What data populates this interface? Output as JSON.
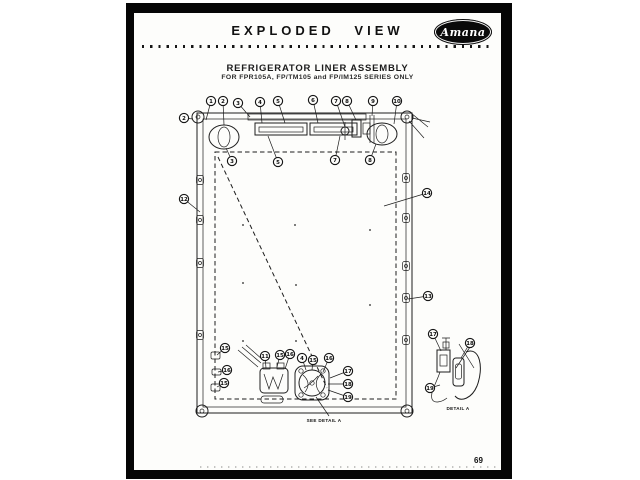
{
  "page": {
    "header": {
      "title": "EXPLODED VIEW",
      "brand": "Amana"
    },
    "subject": {
      "line1": "REFRIGERATOR LINER ASSEMBLY",
      "line2": "FOR FPR105A, FP/TM105 and FP/IM125 SERIES ONLY"
    },
    "captions": {
      "see_detail": "SEE DETAIL A",
      "detail": "DETAIL A"
    },
    "page_number": "69"
  },
  "colors": {
    "ink": "#1d1d1d",
    "paper": "#fdfdfb",
    "border": "#050505"
  },
  "icons": {
    "brand_logo": "amana-oval-logo"
  },
  "callouts": [
    {
      "n": "1",
      "x": 211,
      "y": 101,
      "lx": 206,
      "ly": 120
    },
    {
      "n": "2",
      "x": 223,
      "y": 101,
      "lx": 224,
      "ly": 125
    },
    {
      "n": "3",
      "x": 238,
      "y": 103,
      "lx": 250,
      "ly": 117
    },
    {
      "n": "4",
      "x": 260,
      "y": 102,
      "lx": 262,
      "ly": 123
    },
    {
      "n": "5",
      "x": 278,
      "y": 101,
      "lx": 285,
      "ly": 123
    },
    {
      "n": "6",
      "x": 313,
      "y": 100,
      "lx": 318,
      "ly": 123
    },
    {
      "n": "7",
      "x": 336,
      "y": 101,
      "lx": 345,
      "ly": 127
    },
    {
      "n": "8",
      "x": 347,
      "y": 101,
      "lx": 356,
      "ly": 120
    },
    {
      "n": "9",
      "x": 373,
      "y": 101,
      "lx": 372,
      "ly": 116
    },
    {
      "n": "10",
      "x": 397,
      "y": 101,
      "lx": 394,
      "ly": 124
    },
    {
      "n": "2",
      "x": 184,
      "y": 118,
      "lx": 193,
      "ly": 119
    },
    {
      "n": "3",
      "x": 232,
      "y": 161,
      "lx": 226,
      "ly": 148
    },
    {
      "n": "5",
      "x": 278,
      "y": 162,
      "lx": 268,
      "ly": 136
    },
    {
      "n": "7",
      "x": 335,
      "y": 160,
      "lx": 340,
      "ly": 136
    },
    {
      "n": "8",
      "x": 370,
      "y": 160,
      "lx": 376,
      "ly": 144
    },
    {
      "n": "12",
      "x": 184,
      "y": 199,
      "lx": 200,
      "ly": 212
    },
    {
      "n": "14",
      "x": 427,
      "y": 193,
      "lx": 384,
      "ly": 206
    },
    {
      "n": "13",
      "x": 428,
      "y": 296,
      "lx": 408,
      "ly": 299
    },
    {
      "n": "15",
      "x": 225,
      "y": 348,
      "lx": 217,
      "ly": 355
    },
    {
      "n": "16",
      "x": 227,
      "y": 370,
      "lx": 218,
      "ly": 372
    },
    {
      "n": "15",
      "x": 224,
      "y": 383,
      "lx": 217,
      "ly": 387
    },
    {
      "n": "11",
      "x": 265,
      "y": 356,
      "lx": 266,
      "ly": 368
    },
    {
      "n": "15",
      "x": 280,
      "y": 355,
      "lx": 277,
      "ly": 367
    },
    {
      "n": "16",
      "x": 290,
      "y": 354,
      "lx": 285,
      "ly": 369
    },
    {
      "n": "4",
      "x": 302,
      "y": 358,
      "lx": 306,
      "ly": 370
    },
    {
      "n": "15",
      "x": 313,
      "y": 360,
      "lx": 312,
      "ly": 370
    },
    {
      "n": "16",
      "x": 329,
      "y": 358,
      "lx": 323,
      "ly": 372
    },
    {
      "n": "17",
      "x": 348,
      "y": 371,
      "lx": 330,
      "ly": 378
    },
    {
      "n": "18",
      "x": 348,
      "y": 384,
      "lx": 328,
      "ly": 384
    },
    {
      "n": "19",
      "x": 348,
      "y": 397,
      "lx": 328,
      "ly": 390
    },
    {
      "n": "17",
      "x": 433,
      "y": 334,
      "lx": 441,
      "ly": 351
    },
    {
      "n": "18",
      "x": 470,
      "y": 343,
      "lx": 461,
      "ly": 358
    },
    {
      "n": "19",
      "x": 430,
      "y": 388,
      "lx": 440,
      "ly": 385
    }
  ]
}
